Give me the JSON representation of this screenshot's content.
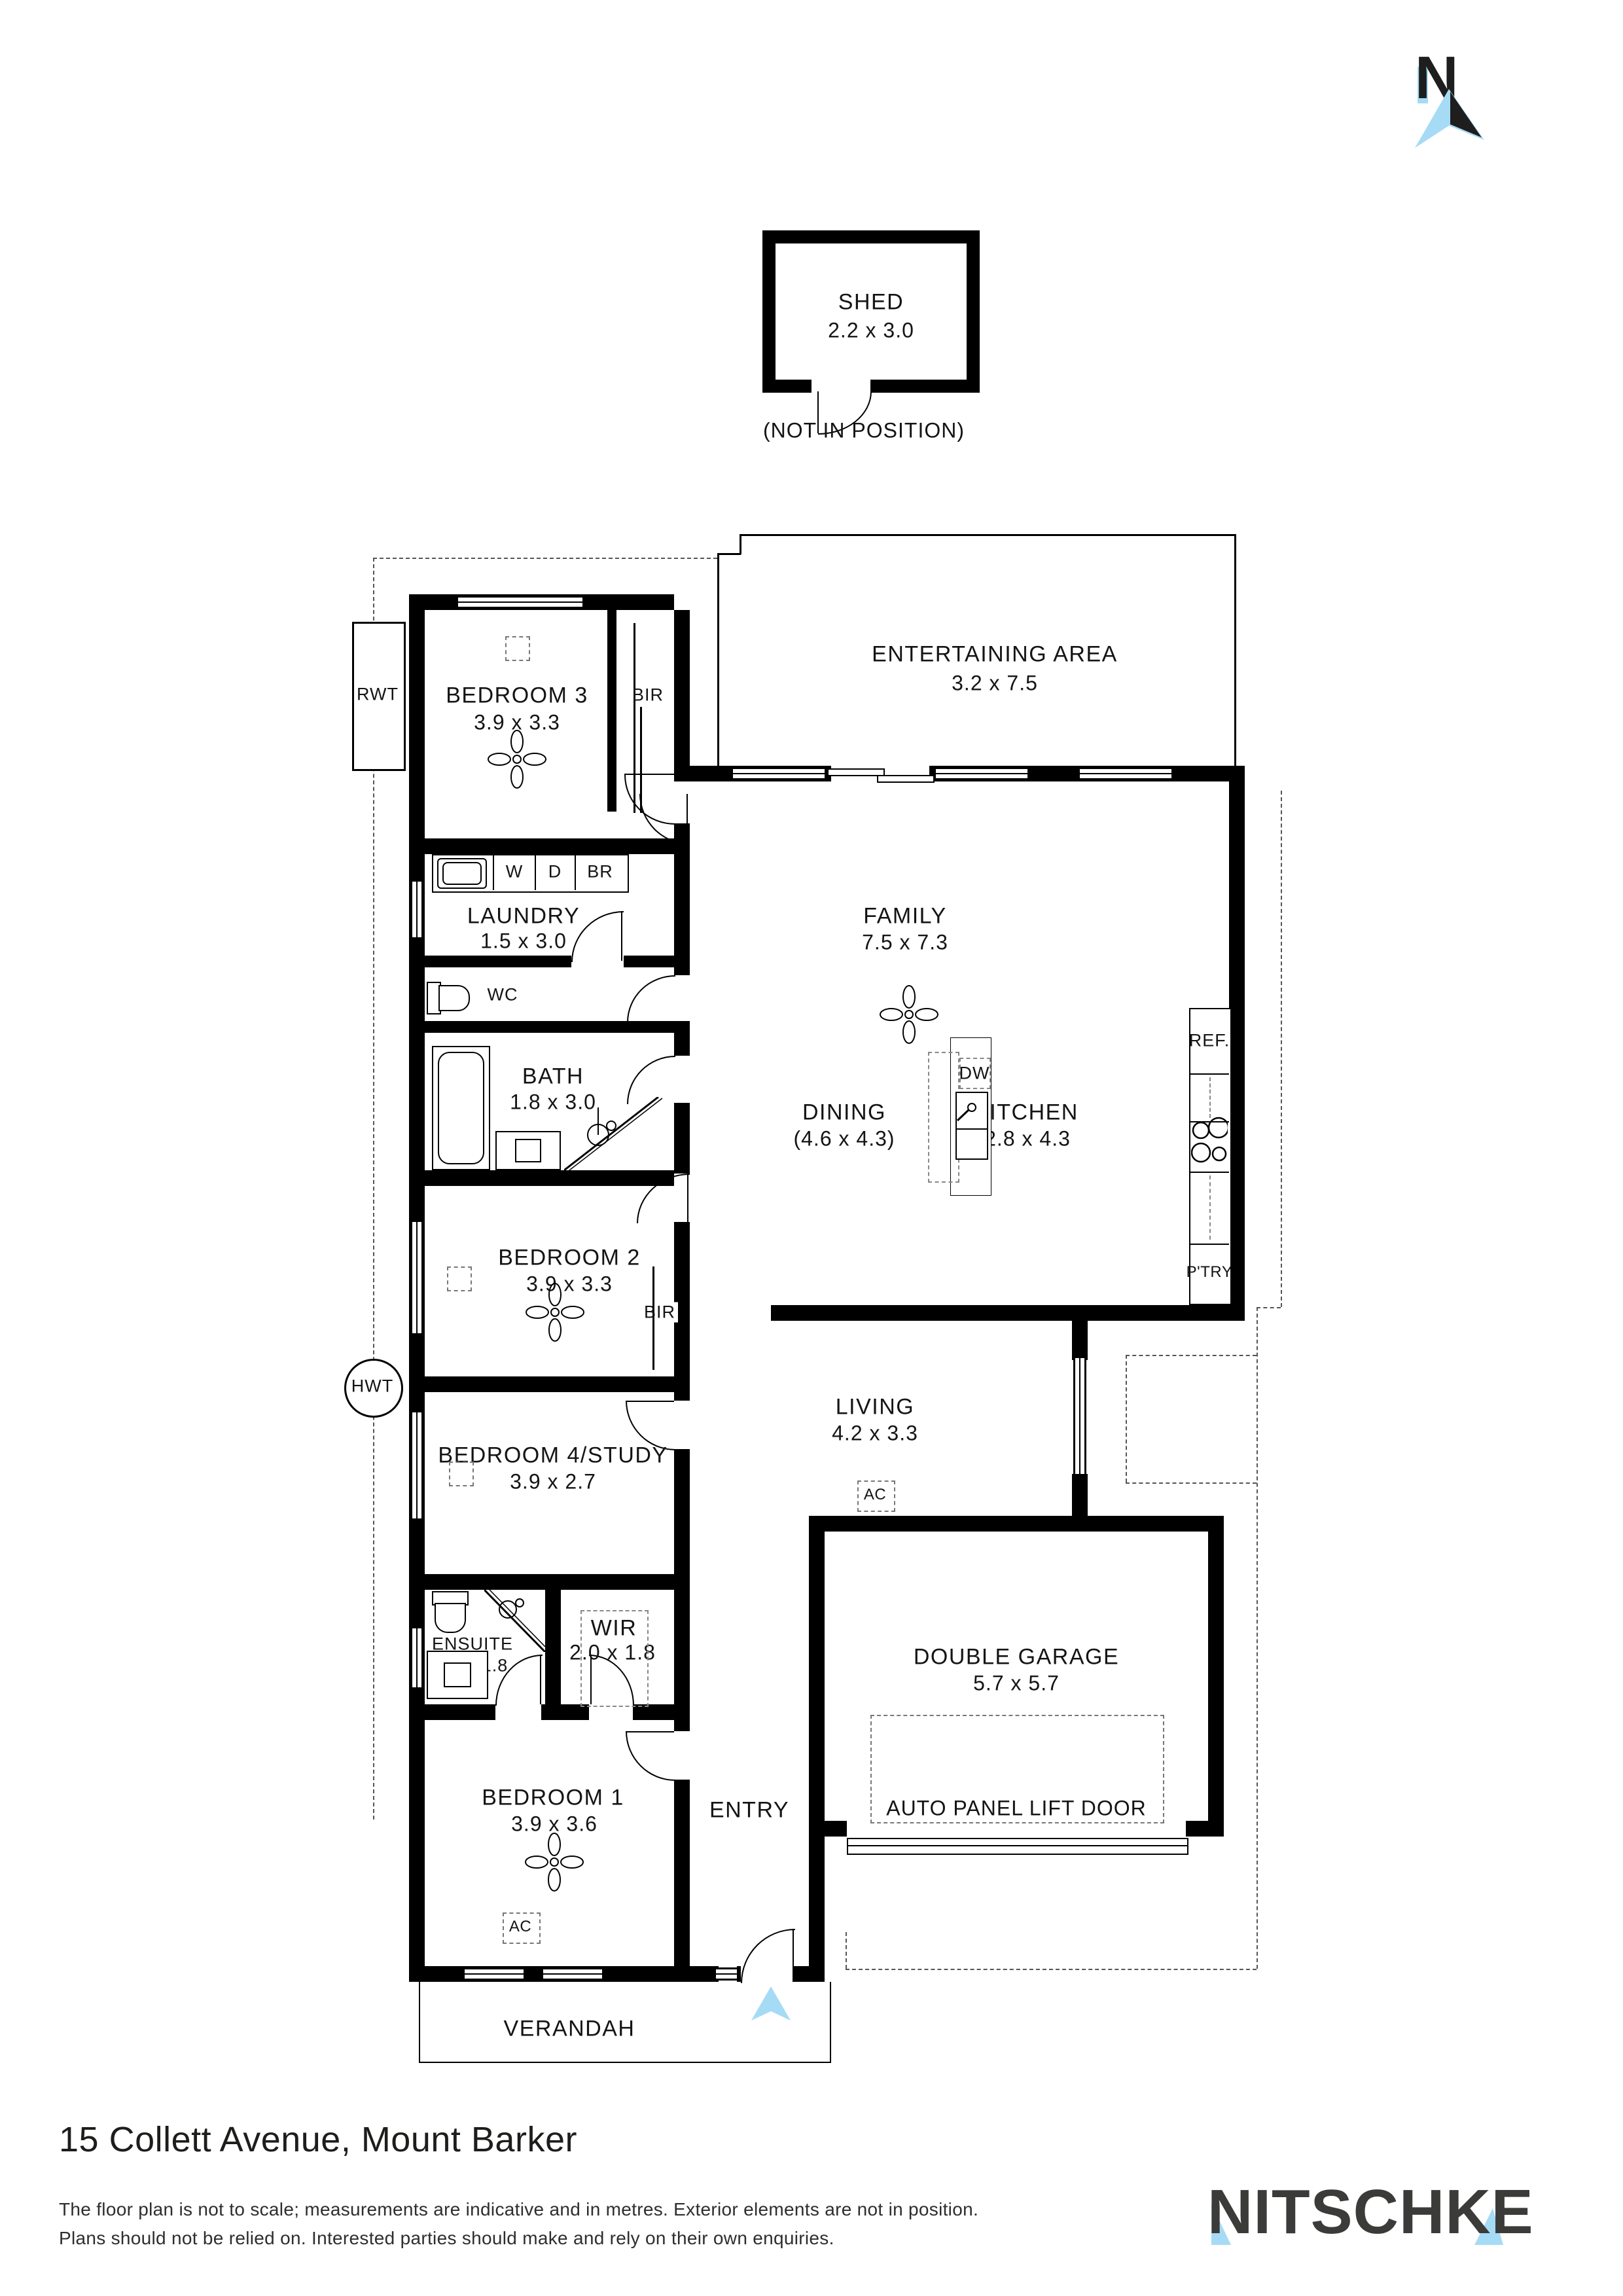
{
  "north_arrow": {
    "letter": "N"
  },
  "shed": {
    "name": "SHED",
    "dims": "2.2 x 3.0",
    "note": "(NOT IN POSITION)"
  },
  "rooms": {
    "entertaining": {
      "name": "ENTERTAINING AREA",
      "dims": "3.2 x 7.5"
    },
    "family": {
      "name": "FAMILY",
      "dims": "7.5 x 7.3"
    },
    "dining": {
      "name": "DINING",
      "dims": "(4.6 x 4.3)"
    },
    "kitchen": {
      "name": "KITCHEN",
      "dims": "2.8 x 4.3"
    },
    "living": {
      "name": "LIVING",
      "dims": "4.2 x 3.3"
    },
    "bedroom3": {
      "name": "BEDROOM 3",
      "dims": "3.9 x 3.3"
    },
    "laundry": {
      "name": "LAUNDRY",
      "dims": "1.5 x 3.0"
    },
    "wc": {
      "name": "WC"
    },
    "bath": {
      "name": "BATH",
      "dims": "1.8 x 3.0"
    },
    "bedroom2": {
      "name": "BEDROOM 2",
      "dims": "3.9 x 3.3"
    },
    "bedroom4": {
      "name": "BEDROOM 4/STUDY",
      "dims": "3.9 x 2.7"
    },
    "ensuite": {
      "name": "ENSUITE",
      "dims": "2.0 x 1.8"
    },
    "wir": {
      "name": "WIR",
      "dims": "2.0 x 1.8"
    },
    "bedroom1": {
      "name": "BEDROOM 1",
      "dims": "3.9 x 3.6"
    },
    "entry": {
      "name": "ENTRY"
    },
    "garage": {
      "name": "DOUBLE GARAGE",
      "dims": "5.7 x 5.7",
      "door": "AUTO PANEL LIFT DOOR"
    },
    "verandah": {
      "name": "VERANDAH"
    }
  },
  "fixtures": {
    "bir": "BIR",
    "washer": "W",
    "dryer": "D",
    "broom": "BR",
    "dishwasher": "DW",
    "fridge": "REF.",
    "pantry": "P'TRY",
    "rainwater_tank": "RWT",
    "hot_water_tank": "HWT",
    "aircon": "AC"
  },
  "colors": {
    "accent_blue": "#A6DBF5",
    "wall": "#000000",
    "logo_dark": "#3B3B39"
  },
  "footer": {
    "address": "15 Collett Avenue, Mount Barker",
    "disclaimer_line1": "The floor plan is not to scale; measurements are indicative and in metres. Exterior elements are not in position.",
    "disclaimer_line2": "Plans should not be relied on. Interested parties should make and rely on their own enquiries.",
    "brand": "NITSCHKE"
  }
}
